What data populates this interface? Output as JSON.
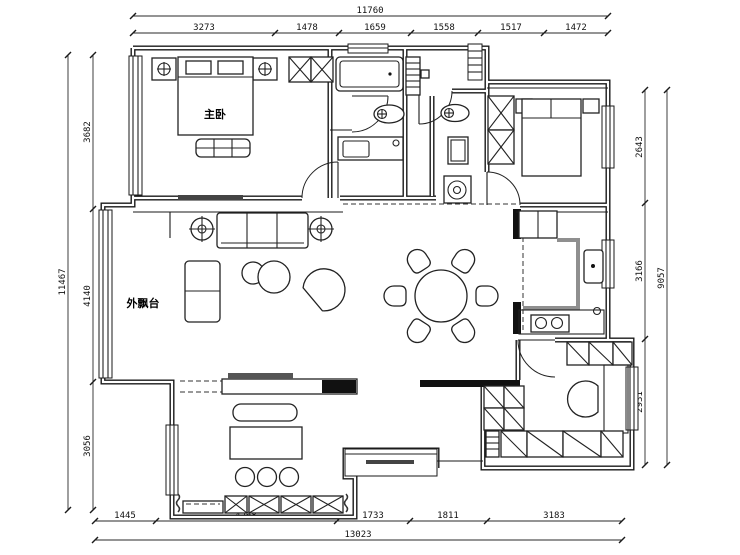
{
  "labels": {
    "master_bedroom": "主卧",
    "bay_window": "外飘台"
  },
  "dims": {
    "top": {
      "total": "11760",
      "segments": [
        "3273",
        "1478",
        "1659",
        "1558",
        "1517",
        "1472"
      ]
    },
    "bottom": {
      "total": "13023",
      "segments": [
        "1445",
        "4268",
        "1733",
        "1811",
        "3183"
      ]
    },
    "left": {
      "total": "11467",
      "segments": [
        "3682",
        "4140",
        "3056"
      ]
    },
    "right": {
      "total": "9057",
      "segments": [
        "2643",
        "3166",
        "2931"
      ]
    }
  },
  "colors": {
    "line": "#1a1a1a",
    "counter_gray": "#8f8f8f",
    "dark_fill": "#111111",
    "tv_gray": "#555555",
    "background": "#ffffff"
  }
}
